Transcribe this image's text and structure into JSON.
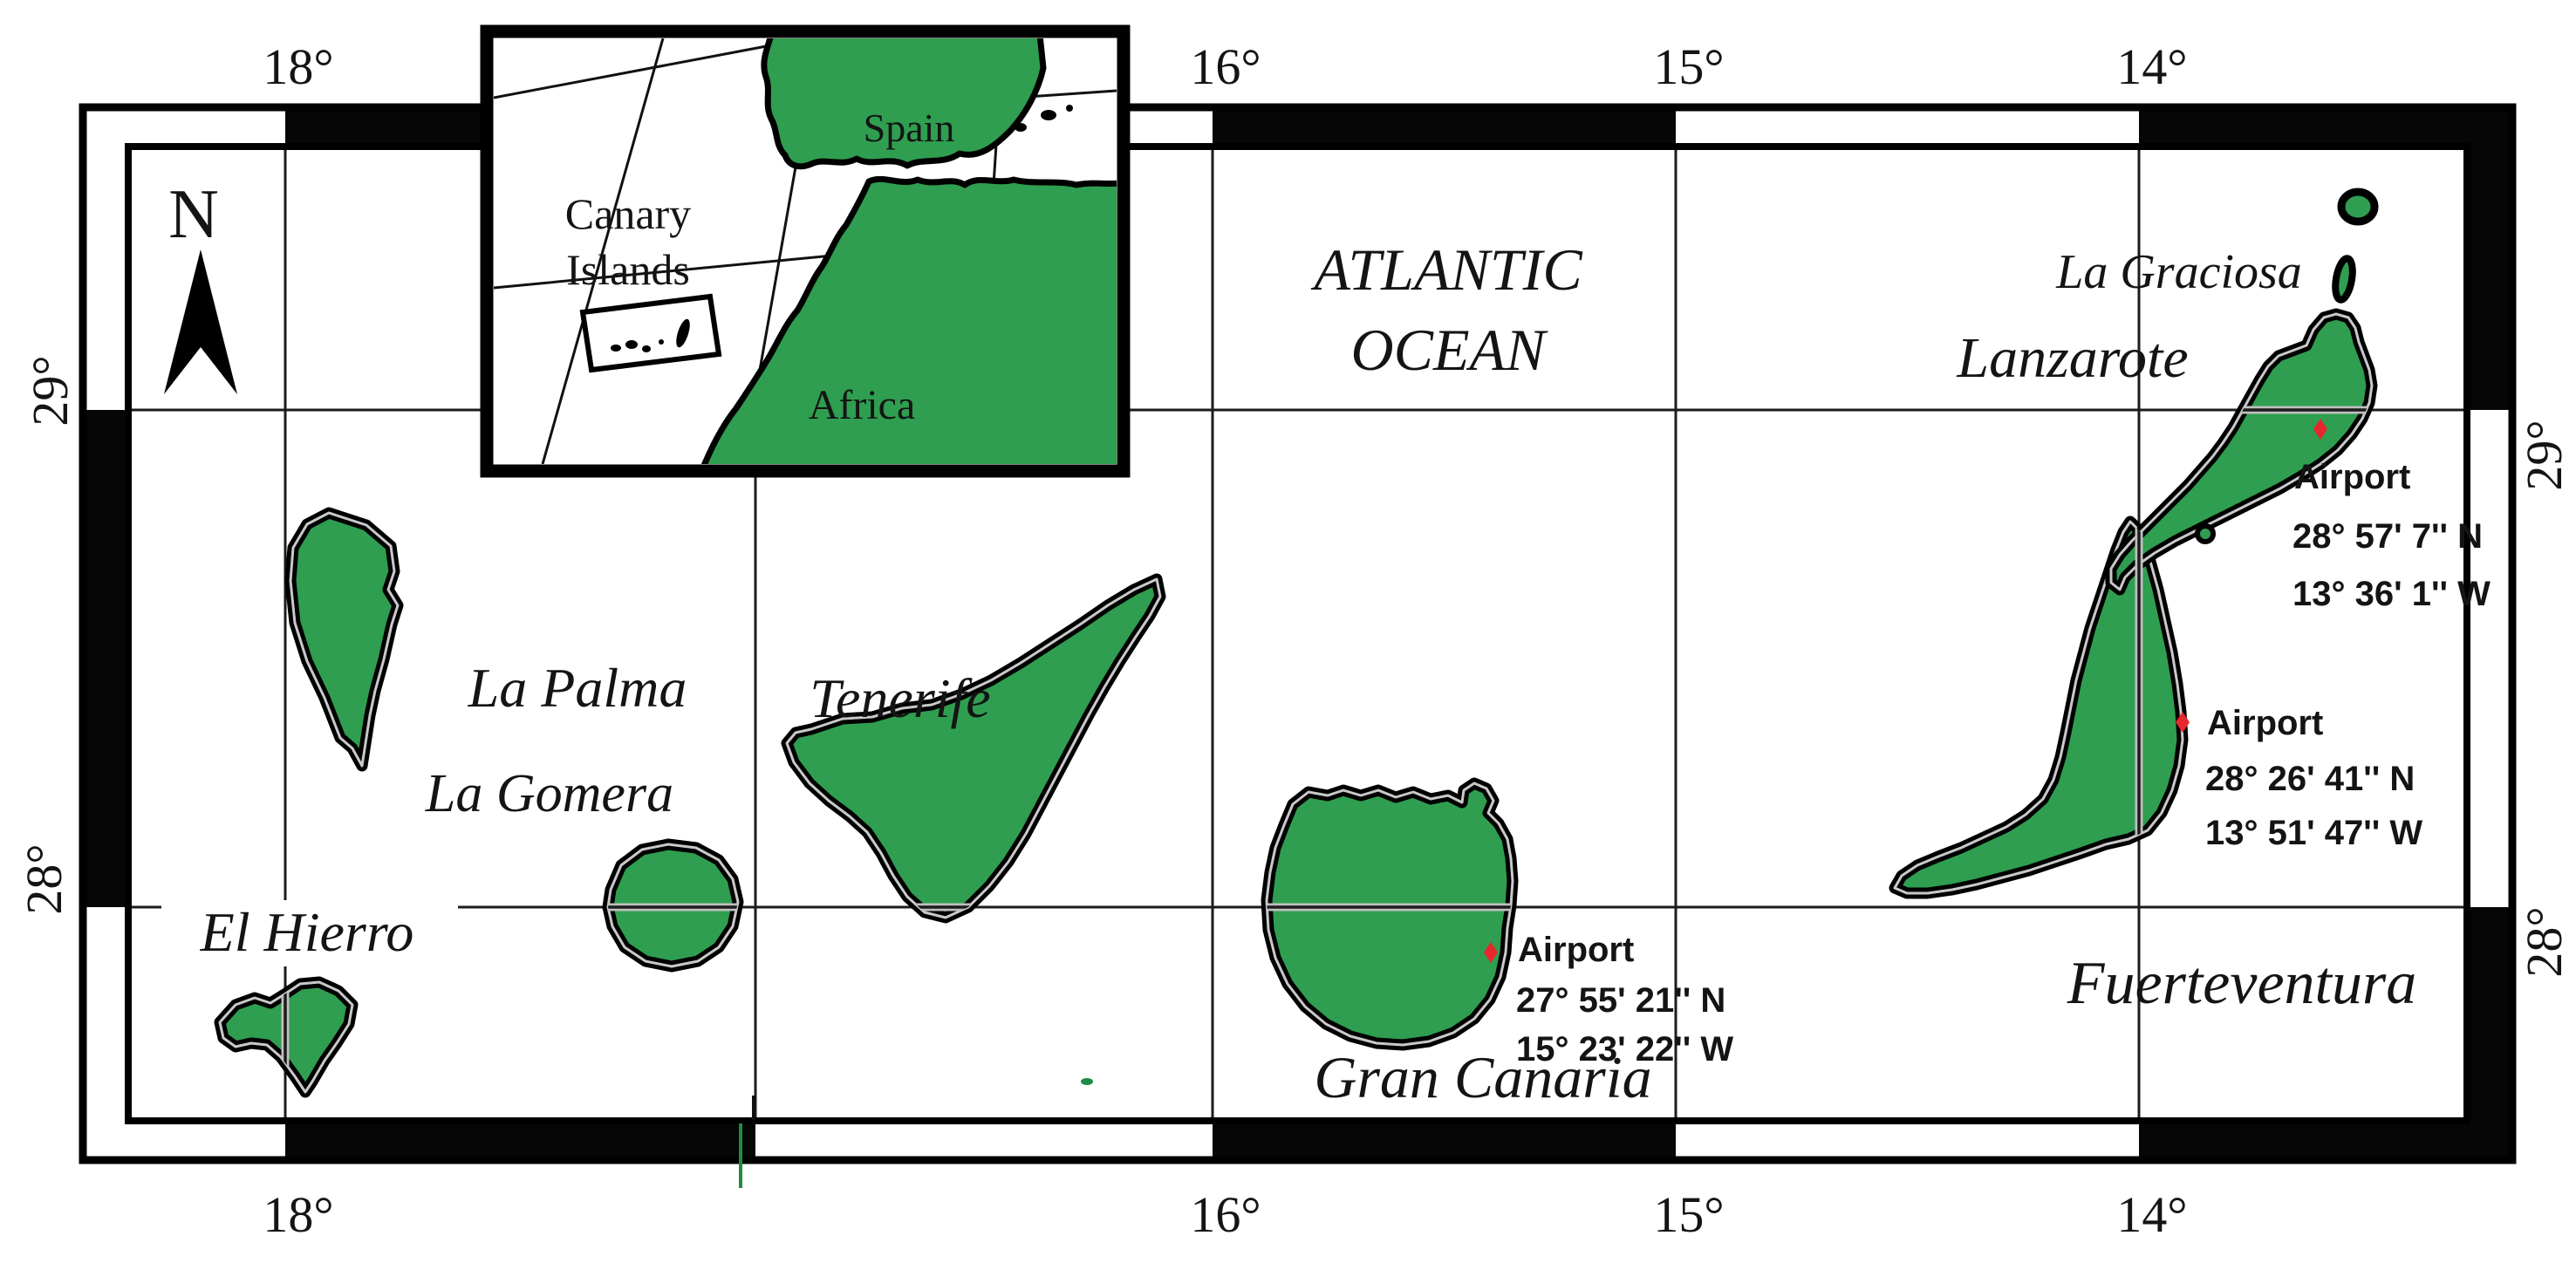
{
  "figure": {
    "ocean": {
      "line1": "ATLANTIC",
      "line2": "OCEAN"
    },
    "north_label": "N",
    "axis": {
      "top": [
        "18°",
        "16°",
        "15°",
        "14°"
      ],
      "bottom": [
        "18°",
        "16°",
        "15°",
        "14°"
      ],
      "left": [
        "29°",
        "28°"
      ],
      "right": [
        "29°",
        "28°"
      ]
    },
    "islands": {
      "la_palma": "La Palma",
      "la_gomera": "La Gomera",
      "el_hierro": "El Hierro",
      "tenerife": "Tenerife",
      "gran_canaria": "Gran Canaria",
      "fuerteventura": "Fuerteventura",
      "lanzarote": "Lanzarote",
      "la_graciosa": "La Graciosa"
    },
    "airports": [
      {
        "island": "Lanzarote",
        "name": "Airport",
        "lat": "28° 57' 7'' N",
        "lon": "13° 36' 1'' W"
      },
      {
        "island": "Fuerteventura",
        "name": "Airport",
        "lat": "28° 26' 41'' N",
        "lon": "13° 51' 47'' W"
      },
      {
        "island": "Gran Canaria",
        "name": "Airport",
        "lat": "27° 55' 21'' N",
        "lon": "15° 23' 22'' W"
      }
    ],
    "inset": {
      "region_line1": "Canary",
      "region_line2": "Islands",
      "spain": "Spain",
      "africa": "Africa"
    },
    "colors": {
      "land_green": "#2f9e50",
      "outline_black": "#000000",
      "grid_dark": "#1c1c1c",
      "grid_casing": "#bfbfbf",
      "marker_red": "#e8262d",
      "text": "#141414"
    }
  }
}
